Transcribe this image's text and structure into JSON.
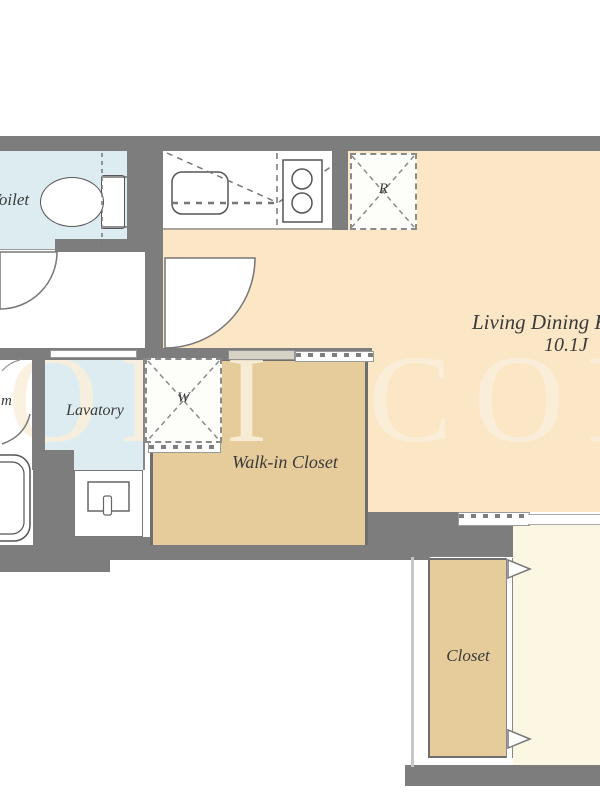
{
  "plan": {
    "watermark": "ORI COR",
    "rooms": {
      "toilet": {
        "label": "Toilet"
      },
      "lavatory": {
        "label": "Lavatory"
      },
      "bathroom": {
        "label_fragment": "m"
      },
      "walk_in_closet": {
        "label": "Walk-in Closet"
      },
      "living_dining": {
        "label": "Living Dining K",
        "size": "10.1J"
      },
      "closet": {
        "label": "Closet"
      }
    },
    "appliances": {
      "refrigerator_symbol": "R",
      "washer_symbol": "W"
    },
    "colors": {
      "wall": "#7d7d7d",
      "living": "#fbe7c6",
      "tan": "#e6cc9a",
      "wet": "#dcecf1",
      "bedroom": "#fcf7e3",
      "watermark": "#faf0dc"
    }
  }
}
